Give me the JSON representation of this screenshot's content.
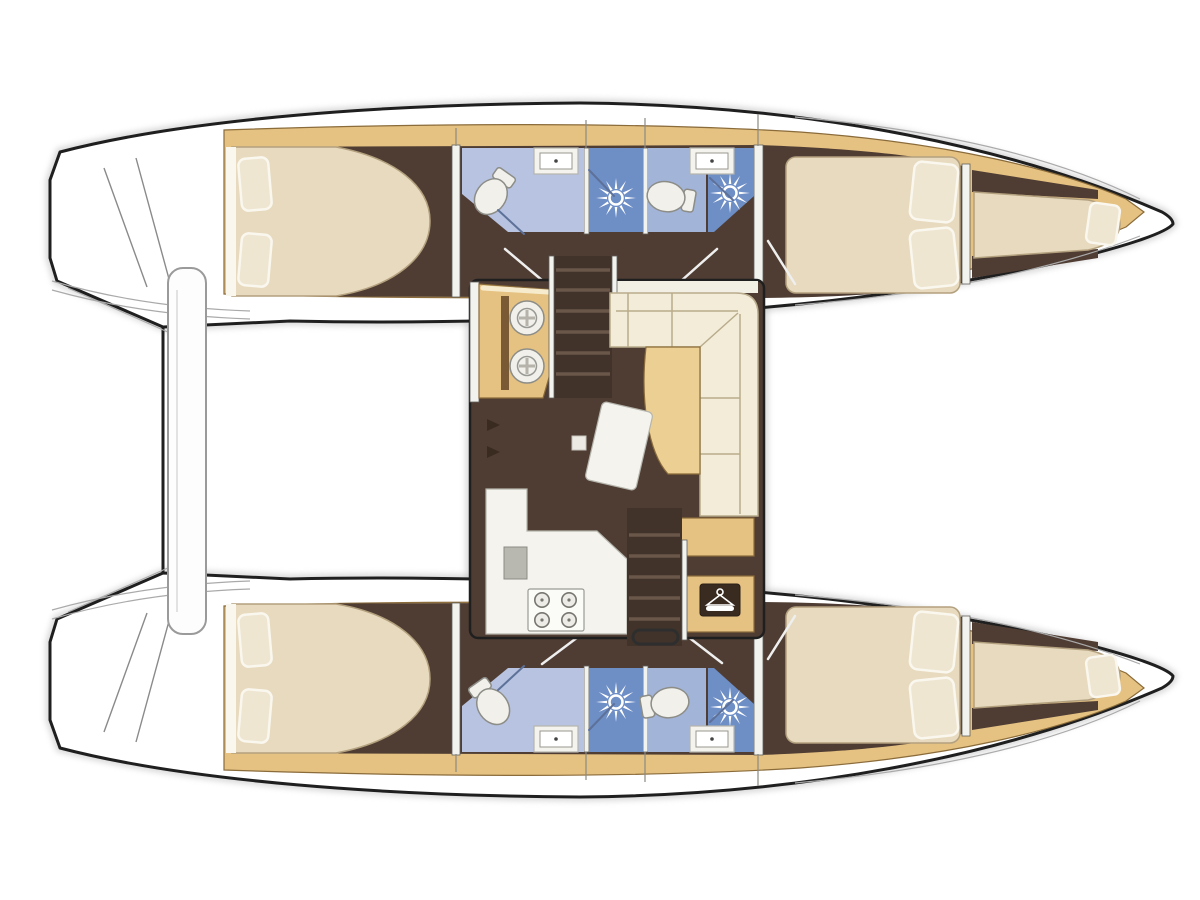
{
  "page": {
    "title": "Catamaran interior layout plan",
    "background": "#ffffff",
    "canvas": {
      "width": 1200,
      "height": 900
    }
  },
  "vessel": {
    "type": "sailing catamaran",
    "view": "top-down interior deck plan",
    "bow_direction": "right",
    "stern_direction": "left",
    "cabins": 4,
    "heads": 4,
    "bow_berths": 2
  },
  "hulls": [
    {
      "id": "upper",
      "position": "top",
      "aft_cabin": {
        "name": "aft double cabin",
        "bed": "island double berth",
        "pillows": 2
      },
      "aft_head": {
        "features": [
          "toilet",
          "washbasin",
          "shower with sunburst shower-head icon"
        ]
      },
      "mid_head": {
        "features": [
          "toilet",
          "washbasin",
          "shower with sunburst shower-head icon"
        ]
      },
      "forward_cabin": {
        "name": "forward double cabin",
        "bed": "double berth",
        "pillows": 2
      },
      "bow": {
        "berth": "single bow berth",
        "pillows": 1
      }
    },
    {
      "id": "lower",
      "position": "bottom",
      "aft_cabin": {
        "name": "aft double cabin",
        "bed": "island double berth",
        "pillows": 2
      },
      "aft_head": {
        "features": [
          "toilet",
          "washbasin",
          "shower with sunburst shower-head icon"
        ]
      },
      "mid_head": {
        "features": [
          "toilet",
          "washbasin",
          "shower with sunburst shower-head icon"
        ]
      },
      "forward_cabin": {
        "name": "forward double cabin",
        "bed": "double berth",
        "pillows": 2
      },
      "bow": {
        "berth": "single bow berth",
        "pillows": 1
      }
    }
  ],
  "saloon": {
    "galley": {
      "sink_unit": "twin round sinks on wood counter",
      "stove": "4-burner cooktop",
      "worktop": "L-shaped white counter with square sink"
    },
    "dinette": {
      "settee": "L-shaped sofa",
      "table": "curved saloon table"
    },
    "nav": {
      "chart_table": "angled chart table",
      "seat": "small stool"
    },
    "storage": {
      "wardrobe": "hanging locker",
      "icon": "clothes-hanger"
    },
    "companionways": [
      "steps down to upper hull",
      "steps down to lower hull"
    ]
  },
  "cockpit": {
    "bench": "aft cockpit bench",
    "transoms": "transom swim steps port and starboard"
  },
  "icons": {
    "shower_head": "white sunburst",
    "hanger": "white clothes hanger on dark plate",
    "faucet": "small dark tap marks"
  },
  "colors": {
    "outline": "#1f1f1f",
    "shadow": "#bdbdbd",
    "deck_white": "#ffffff",
    "deck_line": "#aaaaaa",
    "wood": "#e5c282",
    "wood_edge": "#8a6b3a",
    "floor_dark": "#4f3d33",
    "bed_cream": "#e7dabe",
    "bed_edge": "#b3a07e",
    "sheet_white": "#faf7ef",
    "pillow": "#efe6d2",
    "bath_floor": "#b7c3e0",
    "bath_floor2": "#a2b4d8",
    "shower_blue": "#6e8ec6",
    "fixture": "#f1f0ea",
    "fixture_edge": "#8d8d88",
    "counter_white": "#f4f3ee",
    "counter_edge": "#b5b5ad",
    "sofa": "#f3ecd8",
    "sofa_edge": "#b9ac8c",
    "table_wood": "#eccf92",
    "stove_white": "#fbfbf8",
    "stair_dark": "#41332a",
    "stair_step": "#6b564a",
    "sink_gray": "#b8b8b0",
    "glass_line": "#5d7199",
    "door_line": "#efefef",
    "icon_dark": "#3a2b21",
    "icon_white": "#ffffff",
    "bench_white": "#fdfdfd",
    "bench_edge": "#9a9a9a",
    "saloon_trim": "#f2efe4"
  }
}
